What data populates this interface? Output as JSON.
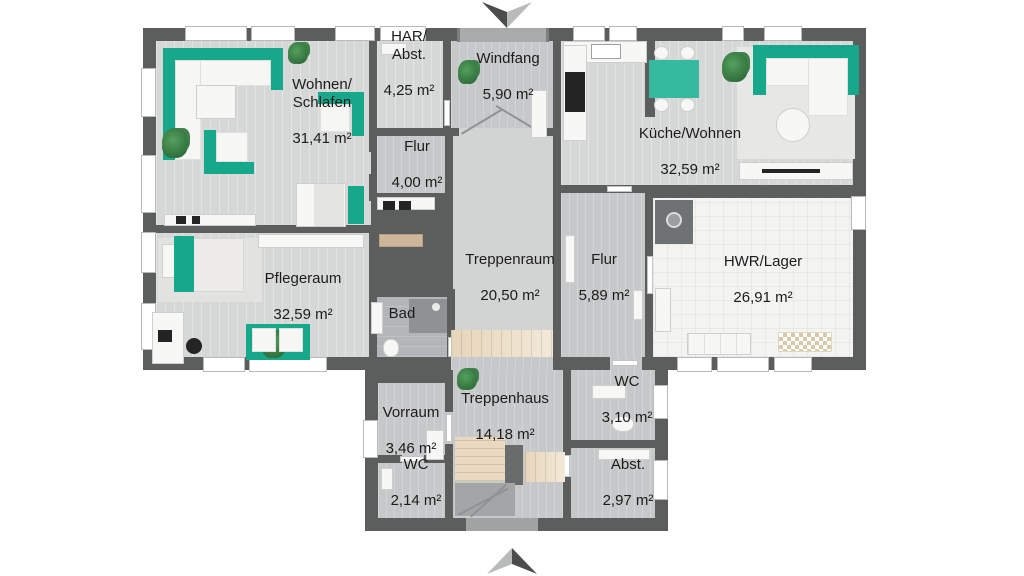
{
  "plan": {
    "type": "floor-plan",
    "rooms": {
      "wohnen": {
        "name": "Wohnen/\nSchlafen",
        "area": "31,41 m²"
      },
      "har": {
        "name": "HAR/\nAbst.",
        "area": "4,25 m²"
      },
      "windfang": {
        "name": "Windfang",
        "area": "5,90 m²"
      },
      "kueche": {
        "name": "Küche/Wohnen",
        "area": "32,59 m²"
      },
      "flur1": {
        "name": "Flur",
        "area": "4,00 m²"
      },
      "treppenraum": {
        "name": "Treppenraum",
        "area": "20,50 m²"
      },
      "flur2": {
        "name": "Flur",
        "area": "5,89 m²"
      },
      "hwr": {
        "name": "HWR/Lager",
        "area": "26,91 m²"
      },
      "pflegeraum": {
        "name": "Pflegeraum",
        "area": "32,59 m²"
      },
      "bad": {
        "name": "Bad",
        "area": ""
      },
      "vorraum": {
        "name": "Vorraum",
        "area": "3,46 m²"
      },
      "treppenhaus": {
        "name": "Treppenhaus",
        "area": "14,18 m²"
      },
      "wc_top": {
        "name": "WC",
        "area": "3,10 m²"
      },
      "wc_bottom": {
        "name": "WC",
        "area": "2,14 m²"
      },
      "abstell": {
        "name": "Abst.",
        "area": "2,97 m²"
      }
    },
    "colors": {
      "wall": "#5c5e5e",
      "floor_light": "#d6d7d7",
      "floor_hall": "#c7c8c9",
      "floor_bath": "#b3b6b8",
      "floor_utility": "#f3f3f1",
      "furniture_accent": "#17a88b",
      "stairs": "#e8d7bd",
      "text": "#1c1c1c"
    },
    "icons": {
      "entrance_top": "entrance-arrow-down",
      "entrance_bottom": "entrance-arrow-up"
    }
  }
}
